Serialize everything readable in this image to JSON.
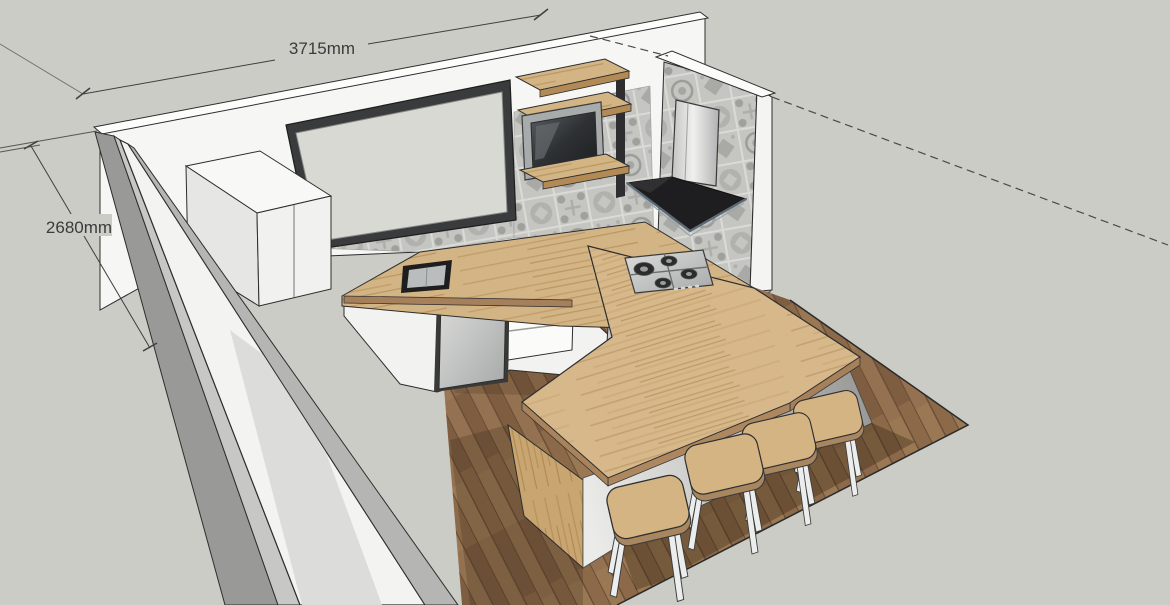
{
  "viewport": {
    "type": "3d-model-view",
    "description": "SketchUp-style 3D kitchen model with dimension annotations",
    "annotations": {
      "width_label": "3715mm",
      "height_label": "2680mm"
    },
    "objects": [
      "back-wall",
      "left-wall",
      "right-wall",
      "window",
      "tile-backsplash",
      "tall-cabinet",
      "wall-shelves",
      "tv",
      "range-hood",
      "kitchen-floor",
      "base-cabinets",
      "dishwasher",
      "drawer-unit",
      "oven",
      "countertop",
      "sink",
      "gas-cooktop",
      "bar-island",
      "bar-stool-1",
      "bar-stool-2",
      "bar-stool-3",
      "bar-stool-4"
    ],
    "palette": {
      "background": "#cbccc6",
      "wall_white": "#f6f6f4",
      "wall_shadow": "#9a9a98",
      "wood_counter": "#d6b88a",
      "wood_floor": "#8b6949",
      "tile_gray": "#c5c5c2",
      "window_frame": "#3a3b3d",
      "hood_black": "#1e1e20",
      "stainless": "#c9cccb",
      "dimension_text": "#3b3b3b"
    }
  }
}
